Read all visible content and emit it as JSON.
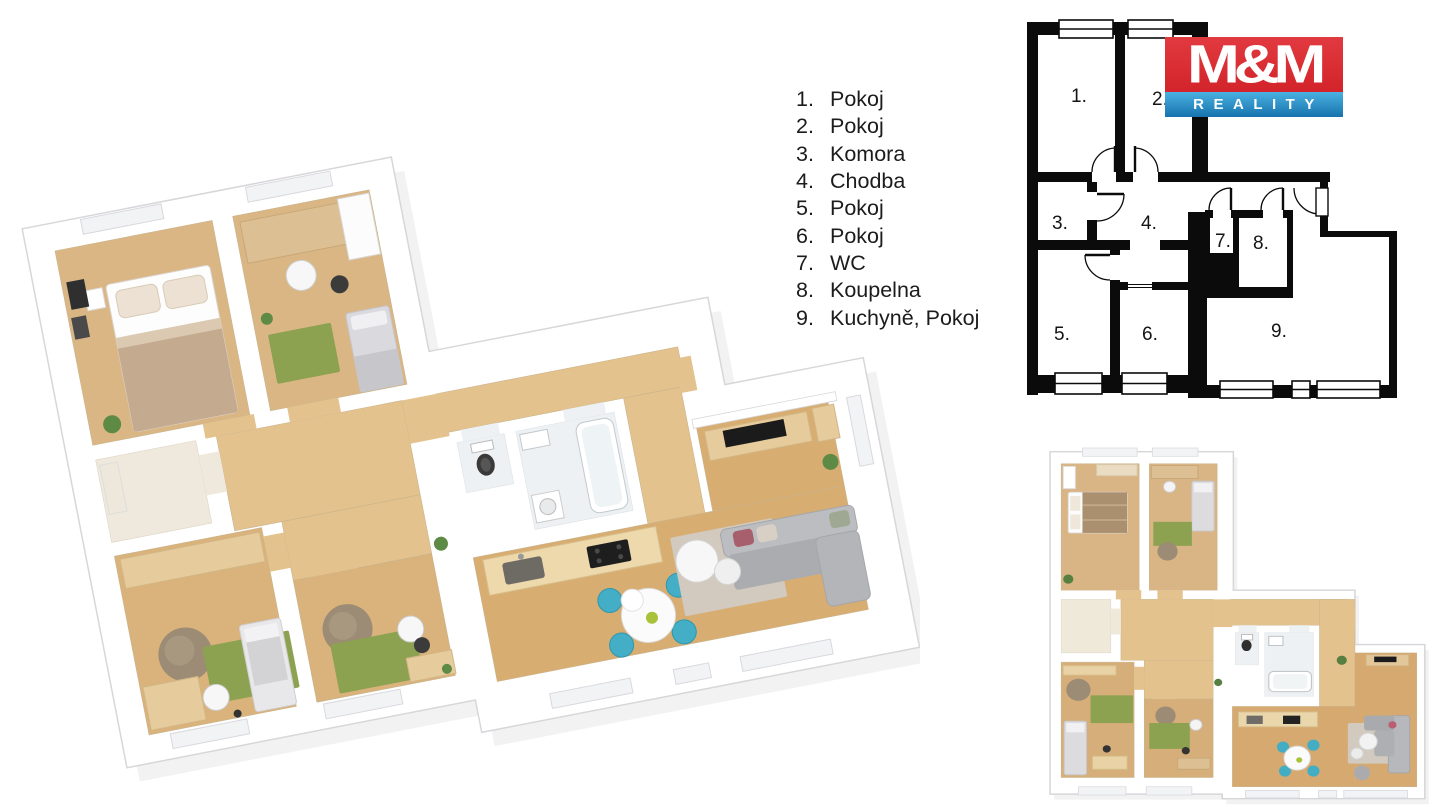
{
  "legend": {
    "items": [
      {
        "number": "1.",
        "label": "Pokoj"
      },
      {
        "number": "2.",
        "label": "Pokoj"
      },
      {
        "number": "3.",
        "label": "Komora"
      },
      {
        "number": "4.",
        "label": "Chodba"
      },
      {
        "number": "5.",
        "label": "Pokoj"
      },
      {
        "number": "6.",
        "label": "Pokoj"
      },
      {
        "number": "7.",
        "label": "WC"
      },
      {
        "number": "8.",
        "label": "Koupelna"
      },
      {
        "number": "9.",
        "label": "Kuchyně, Pokoj"
      }
    ]
  },
  "logo": {
    "name": "M&M",
    "tagline": "REALITY",
    "colors": {
      "red": "#d2242a",
      "blue": "#2d96cc"
    }
  },
  "plan2d": {
    "rooms": [
      "1.",
      "2.",
      "3.",
      "4.",
      "5.",
      "6.",
      "7.",
      "8.",
      "9."
    ],
    "wall_color": "#0b0b0b"
  },
  "palette": {
    "floor_wood": "#d9b27c",
    "floor_wood_light": "#e3c28d",
    "rug_green": "#8ca250",
    "sofa_gray": "#b3b4b7",
    "chair_teal": "#45aec7",
    "beanbag_brown": "#9c8c75",
    "bath_tile": "#eef1f3"
  }
}
